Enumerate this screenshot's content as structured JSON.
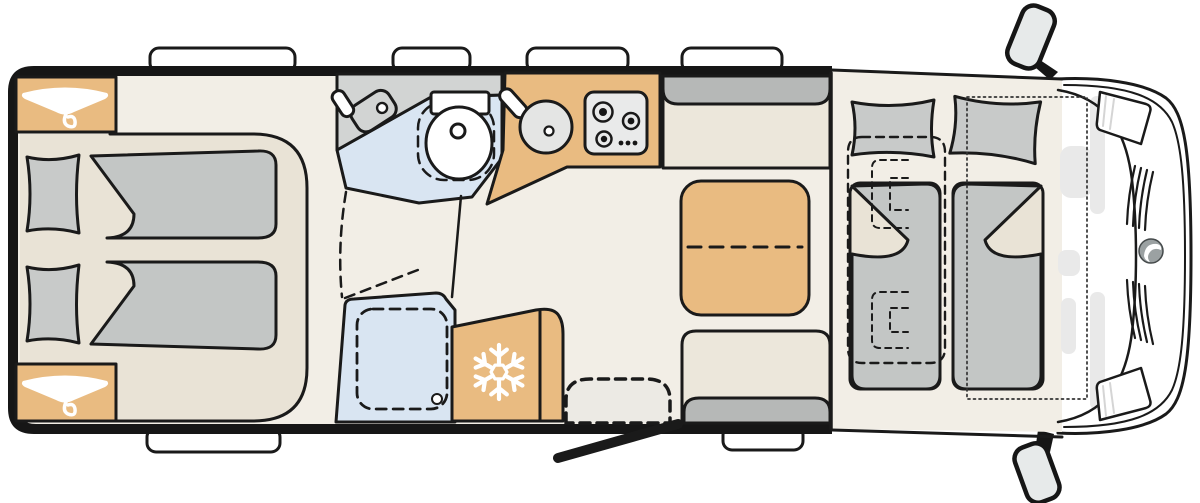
{
  "document": {
    "kind": "motorhome-floorplan-top-view",
    "orientation": "cab-at-right"
  },
  "colors": {
    "wall": "#161616",
    "floor": "#f2eee6",
    "platform": "#e9e3d6",
    "bench": "#ece7db",
    "tan": "#e9bb81",
    "pillow": "#c8cac9",
    "blanket": "#c3c6c5",
    "gray_band": "#b6b8b7",
    "counter": "#d2d4d3",
    "blue": "#d9e5f2",
    "stove": "#e9eaea",
    "sink": "#e4e5e4",
    "white": "#ffffff",
    "step": "#eceae4",
    "mirror": "#e7eaea",
    "dash_panel": "#e9e9e9",
    "line": "#1a1a1a",
    "logo": "#9ba1a2"
  },
  "icons": [
    {
      "name": "hanger-icon",
      "location": "rear-wardrobe-top",
      "color": "#ffffff"
    },
    {
      "name": "hanger-icon",
      "location": "rear-wardrobe-bottom",
      "color": "#ffffff"
    },
    {
      "name": "snowflake-icon",
      "location": "refrigerator",
      "color": "#ffffff"
    }
  ],
  "zones": [
    "rear-twin-beds",
    "wardrobes",
    "washroom",
    "shower",
    "kitchen",
    "refrigerator",
    "dinette",
    "entry-door",
    "drop-down-bed",
    "driver-cab"
  ],
  "counts": {
    "hob_burners": 3,
    "hob_knob_dots": 3,
    "roof_windows_top": 4,
    "windows_bottom": 2,
    "rear_beds": 2,
    "dropdown_bed_places": 2
  }
}
